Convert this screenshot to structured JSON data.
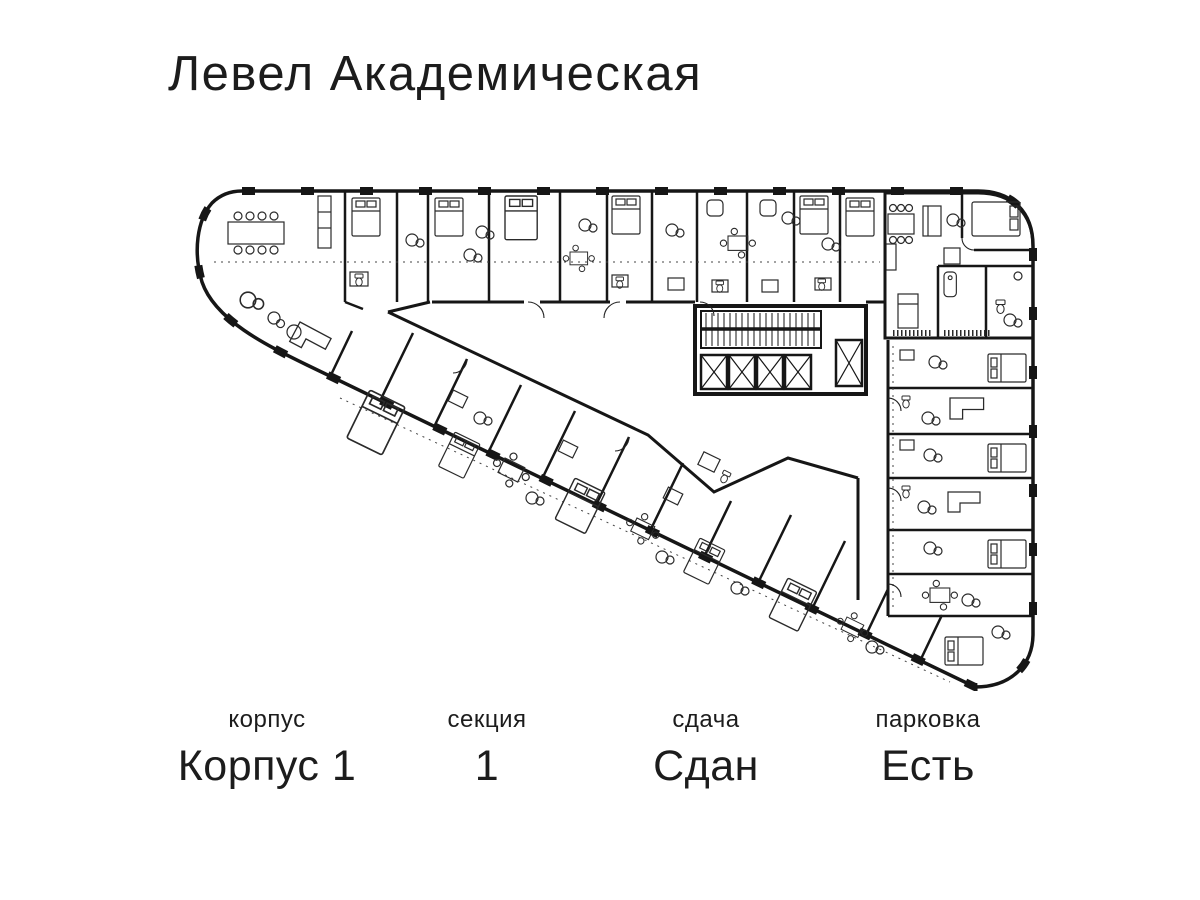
{
  "title": "Левел Академическая",
  "info": {
    "items": [
      {
        "label": "корпус",
        "value": "Корпус 1"
      },
      {
        "label": "секция",
        "value": "1"
      },
      {
        "label": "сдача",
        "value": "Сдан"
      },
      {
        "label": "парковка",
        "value": "Есть"
      }
    ]
  },
  "colors": {
    "background": "#ffffff",
    "ink": "#1c1c1c",
    "highlight": "#a8a8a8"
  },
  "plan": {
    "description": "Triangular residential floor plan, building Корпус 1, section 1, with highlighted apartment at top right",
    "highlighted_unit": "apartment-top-right"
  }
}
